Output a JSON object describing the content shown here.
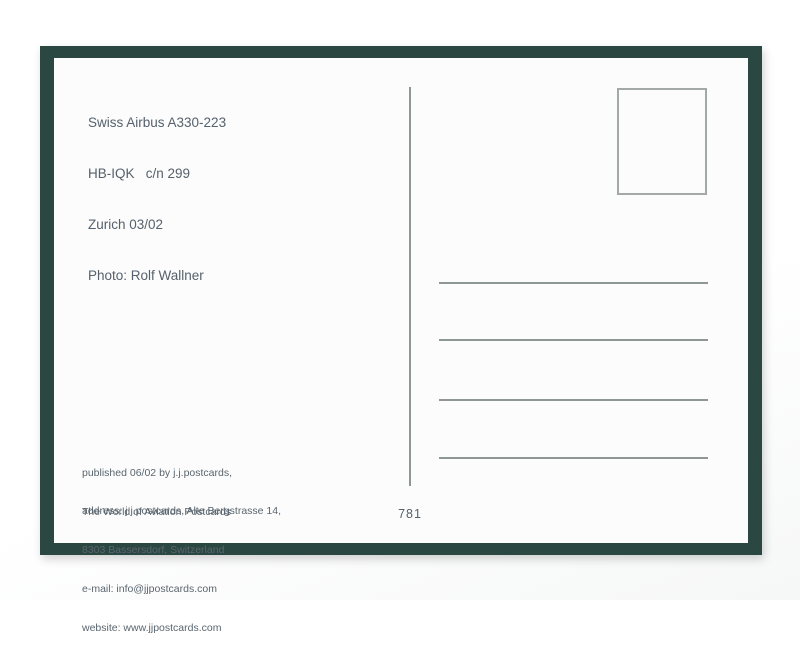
{
  "postcard": {
    "caption": {
      "lines": [
        "Swiss Airbus A330-223",
        "HB-IQK   c/n 299",
        "Zurich 03/02",
        "Photo: Rolf Wallner"
      ]
    },
    "imprint": {
      "publisher_lines": [
        "published 06/02 by j.j.postcards,",
        "The World of Aviation Postcards"
      ],
      "address_lines": [
        "address: j.j.postcards, Alte Bergstrasse 14,",
        "8303 Bassersdorf, Switzerland",
        "e-mail: info@jjpostcards.com",
        "website: www.jjpostcards.com"
      ]
    },
    "card_number": "781",
    "address_ruled_lines_count": 4,
    "colors": {
      "frame_green": "#2a4741",
      "card_white": "#fcfcfc",
      "rule_gray": "#8f9696",
      "text_gray": "#55616c"
    }
  }
}
